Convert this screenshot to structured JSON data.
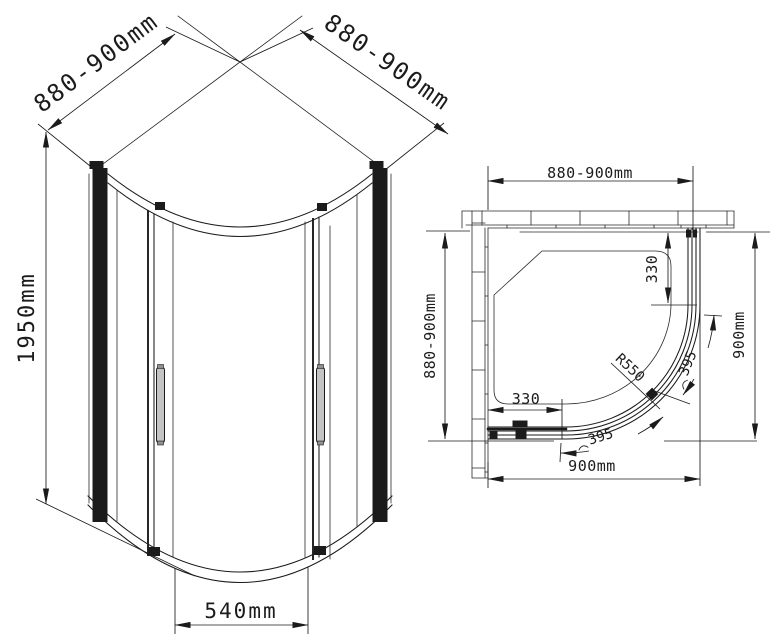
{
  "front_view": {
    "width_left_label": "880-900mm",
    "width_right_label": "880-900mm",
    "height_label": "1950mm",
    "door_opening_label": "540mm"
  },
  "plan_view": {
    "width_top_label": "880-900mm",
    "depth_left_label": "880-900mm",
    "width_bottom_label": "900mm",
    "depth_right_label": "900mm",
    "fixed_panel_right_label": "330",
    "fixed_panel_bottom_label": "330",
    "radius_label": "R550",
    "door_arc_upper_label": "395",
    "door_arc_lower_label": "395"
  },
  "colors": {
    "line": "#1b1b1b",
    "background": "#ffffff",
    "handle_fill": "#c4c4c4"
  }
}
